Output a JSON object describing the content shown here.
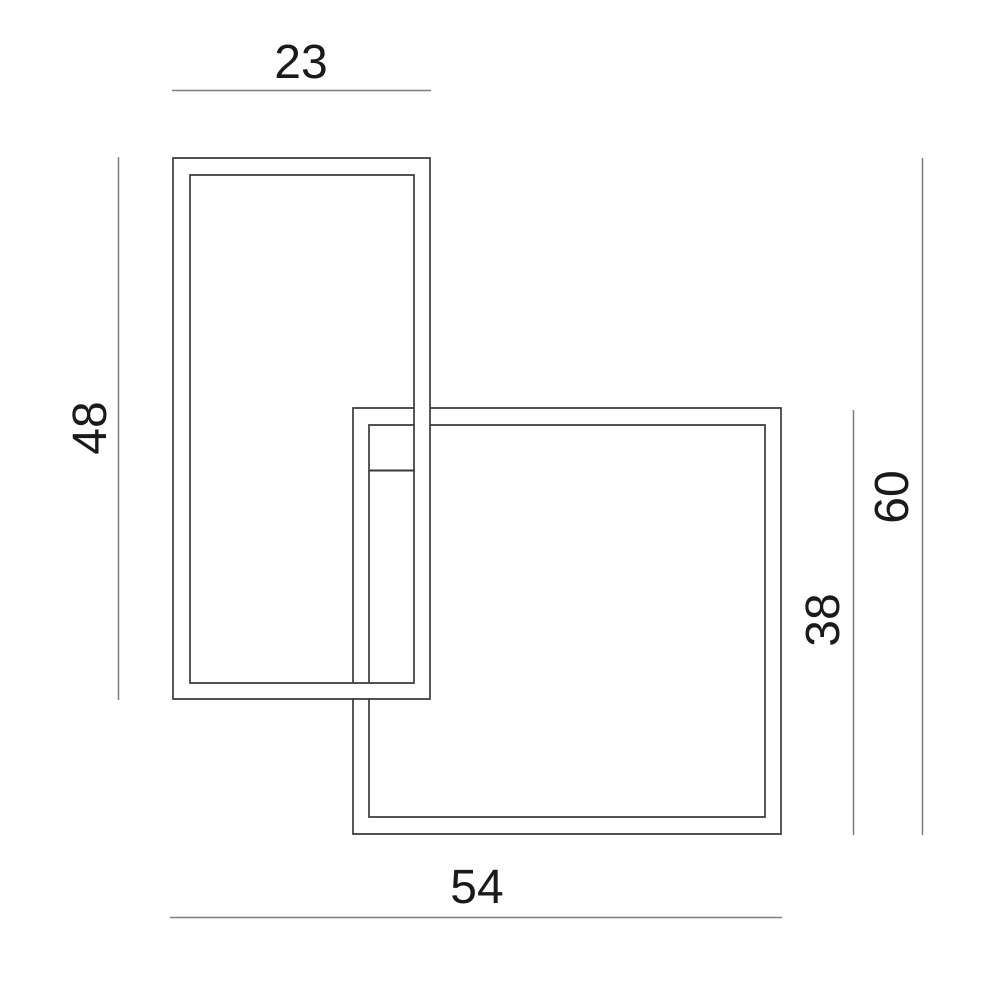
{
  "diagram": {
    "type": "dimension-drawing",
    "dimensions": {
      "top": {
        "label": "23",
        "value": 23
      },
      "left": {
        "label": "48",
        "value": 48
      },
      "right_total": {
        "label": "60",
        "value": 60
      },
      "right_square": {
        "label": "38",
        "value": 38
      },
      "bottom": {
        "label": "54",
        "value": 54
      }
    },
    "colors": {
      "frame": "#3a3a3a",
      "dimension_line": "#7f7f7f",
      "text": "#1a1a1a",
      "background": "#ffffff"
    }
  }
}
